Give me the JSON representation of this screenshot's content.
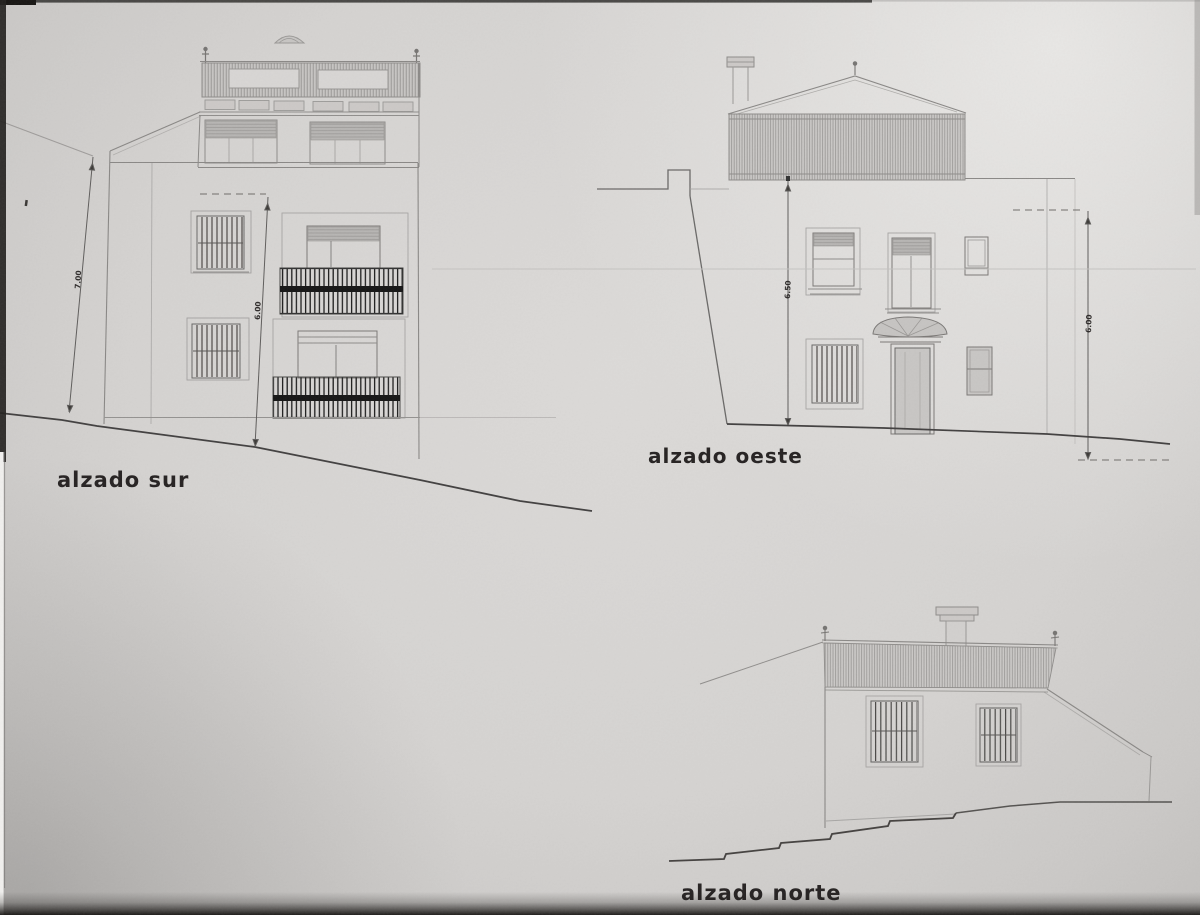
{
  "drawing": {
    "title_note": "scanned architectural elevation sheet",
    "elevations": [
      {
        "name": "south",
        "label": "alzado sur",
        "dimension_labels": [
          "7.00",
          "6.00"
        ]
      },
      {
        "name": "west",
        "label": "alzado oeste",
        "dimension_labels": [
          "6.50",
          "6.00"
        ]
      },
      {
        "name": "north",
        "label": "alzado norte",
        "dimension_labels": []
      }
    ]
  }
}
